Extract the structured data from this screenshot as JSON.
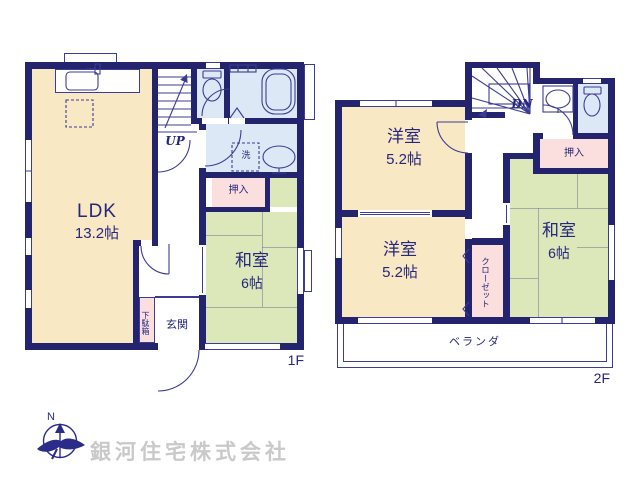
{
  "floors": {
    "f1": {
      "label": "1F",
      "ldk": {
        "name": "LDK",
        "area": "13.2帖"
      },
      "washitsu": {
        "name": "和室",
        "area": "6帖"
      },
      "oshiire": "押入",
      "laundry": "洗",
      "genkan": "玄関",
      "getabako": "下駄箱",
      "stairs": "UP"
    },
    "f2": {
      "label": "2F",
      "yoshitsu_a": {
        "name": "洋室",
        "area": "5.2帖"
      },
      "yoshitsu_b": {
        "name": "洋室",
        "area": "5.2帖"
      },
      "washitsu": {
        "name": "和室",
        "area": "6帖"
      },
      "oshiire": "押入",
      "closet": "クローゼット",
      "veranda": "ベランダ",
      "stairs": "DN"
    },
    "compass": {
      "north": "N"
    },
    "company": {
      "name": "銀河住宅株式会社"
    }
  },
  "colors": {
    "wall": "#23236E",
    "line": "#3C3C94",
    "text": "#26267C",
    "room_cream": "#F8E8C4",
    "tatami_green": "#DCE7BA",
    "closet_pink": "#FBDFDE",
    "bath_blue": "#DCE8F5",
    "watermark": "#C9C9CA"
  }
}
